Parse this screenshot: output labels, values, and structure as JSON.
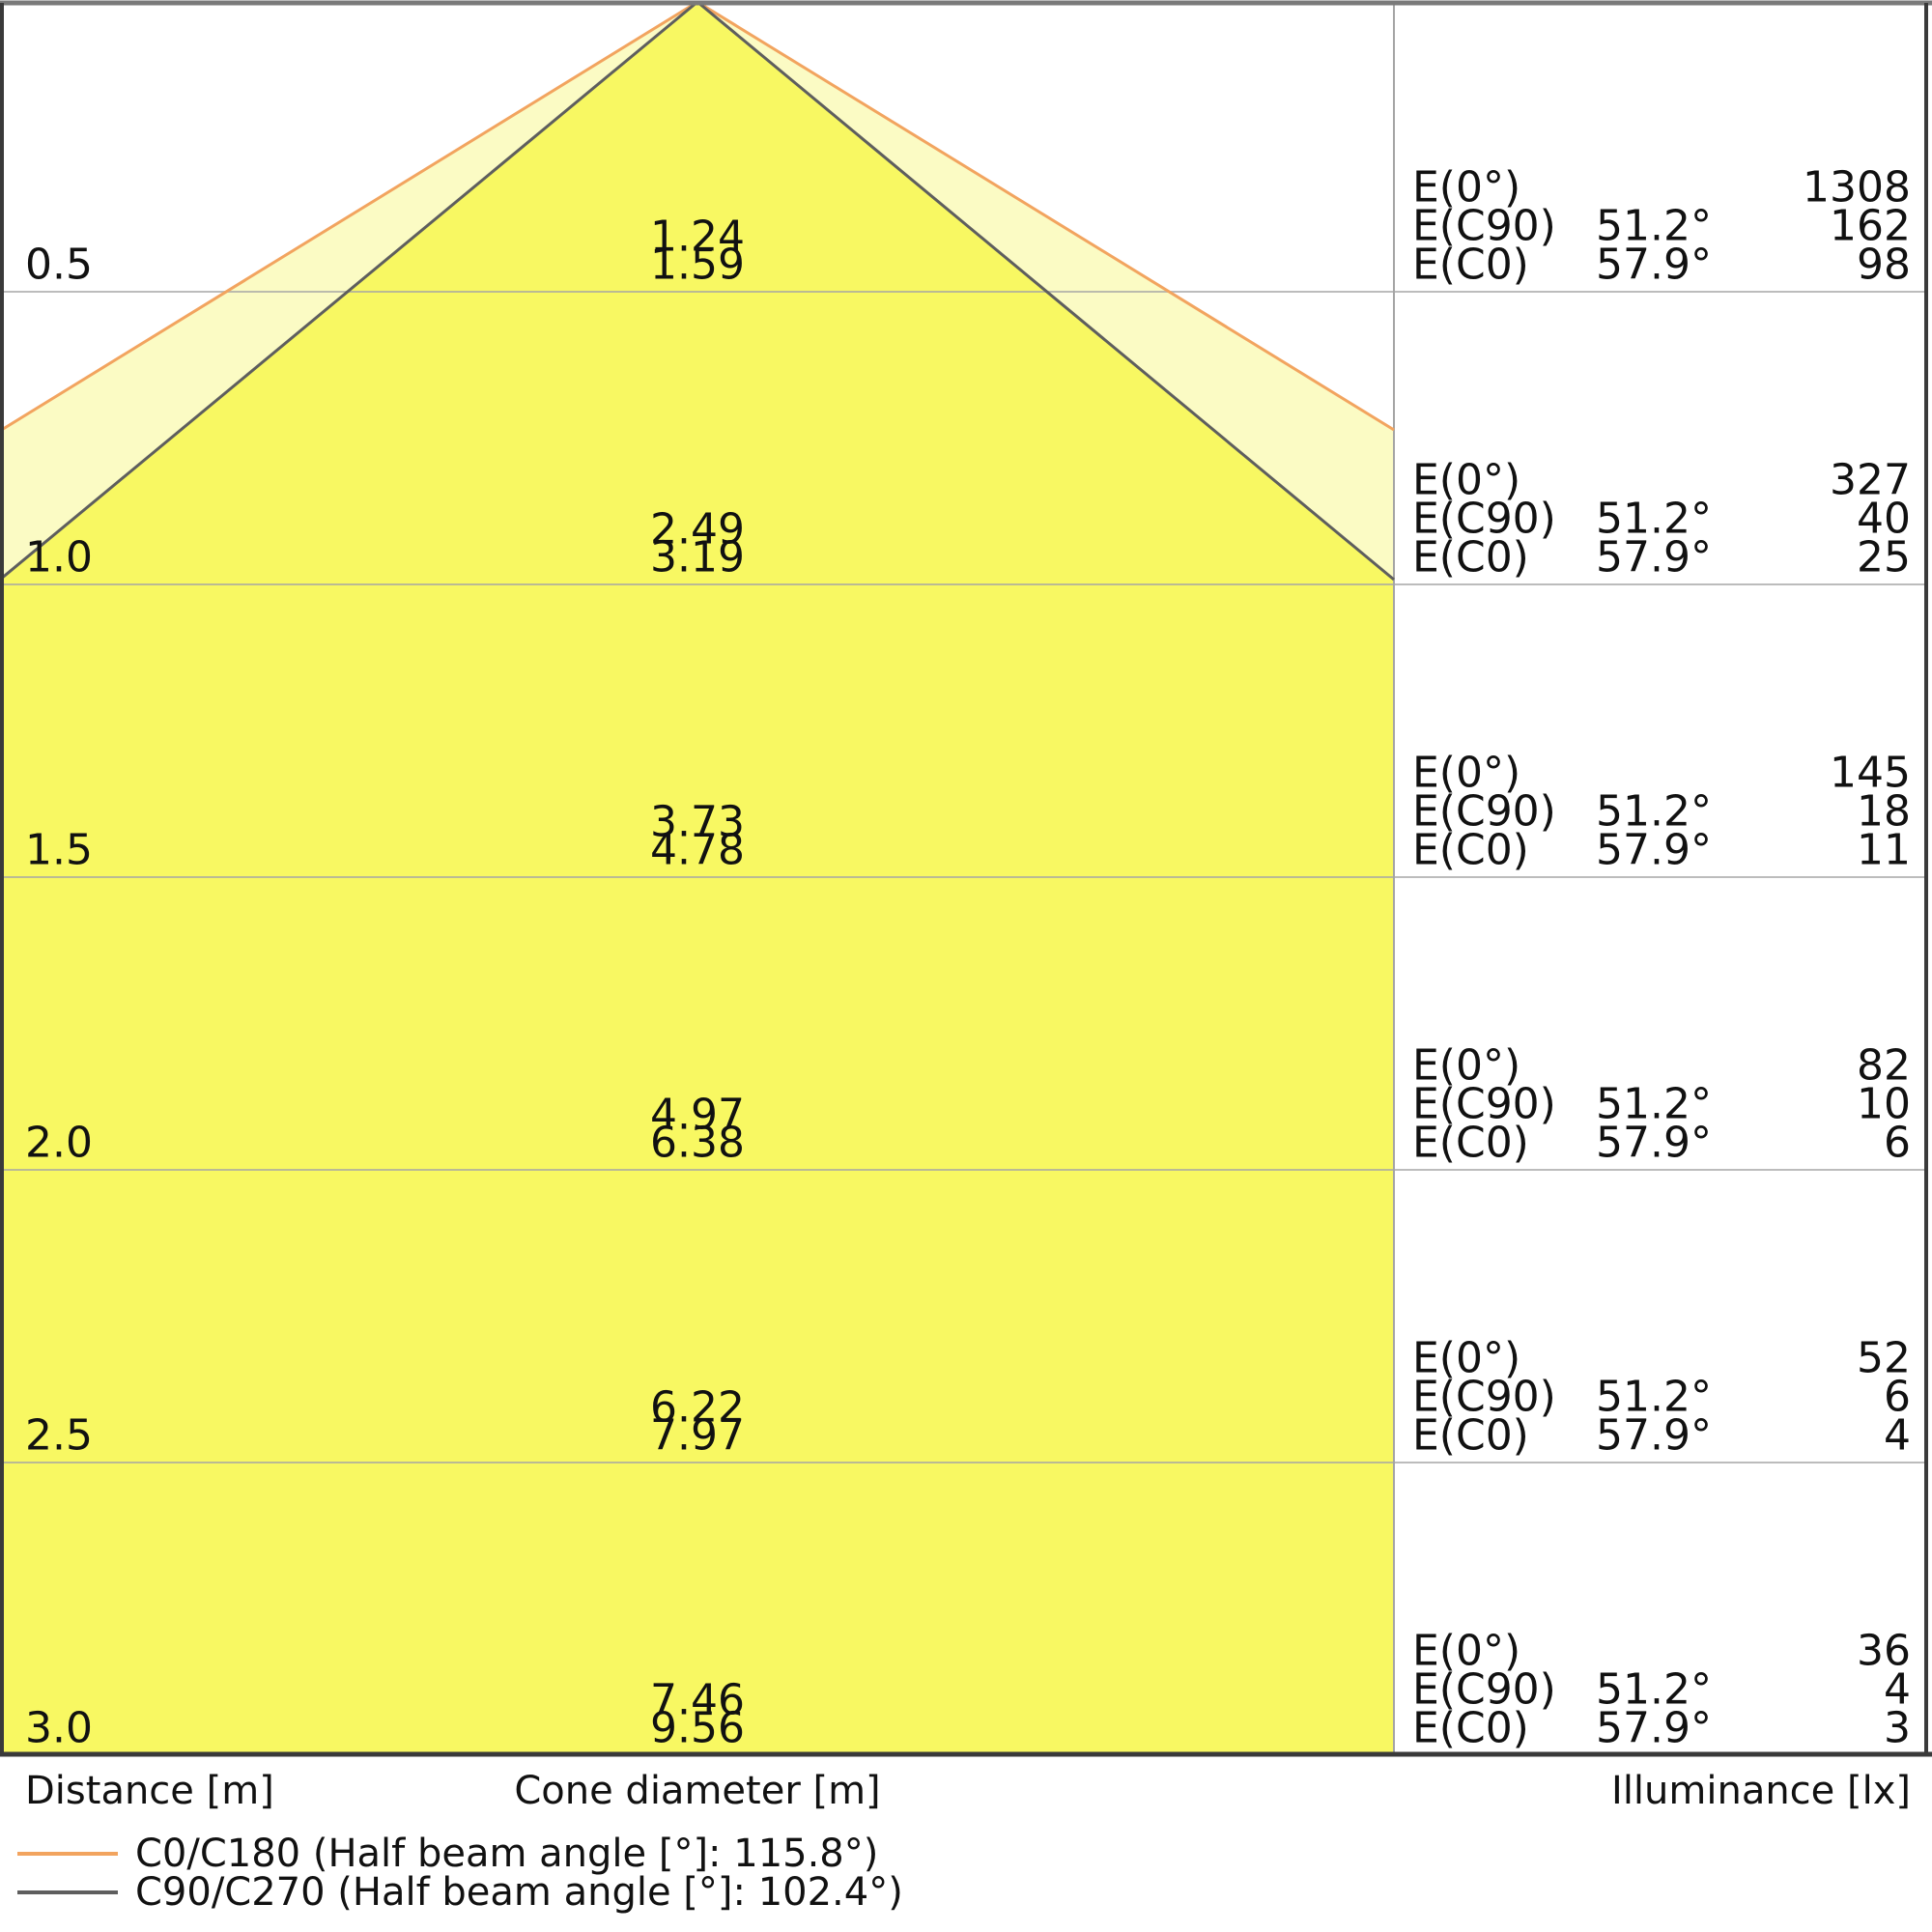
{
  "chart_data": {
    "type": "cone-diagram",
    "description": "Photometric light cone diagram: cone diameter and illuminance versus distance for beam planes C0/C180 and C90/C270",
    "axis_labels": {
      "distance": "Distance [m]",
      "cone_diameter": "Cone diameter [m]",
      "illuminance": "Illuminance [lx]"
    },
    "e_row_labels": {
      "e0": "E(0°)",
      "ec90": "E(C90)",
      "ec0": "E(C0)"
    },
    "angles": {
      "ec90": "51.2°",
      "ec0": "57.9°"
    },
    "rows": [
      {
        "distance": "0.5",
        "cone_c90": "1.24",
        "cone_c0": "1.59",
        "e0": "1308",
        "ec90": "162",
        "ec0": "98"
      },
      {
        "distance": "1.0",
        "cone_c90": "2.49",
        "cone_c0": "3.19",
        "e0": "327",
        "ec90": "40",
        "ec0": "25"
      },
      {
        "distance": "1.5",
        "cone_c90": "3.73",
        "cone_c0": "4.78",
        "e0": "145",
        "ec90": "18",
        "ec0": "11"
      },
      {
        "distance": "2.0",
        "cone_c90": "4.97",
        "cone_c0": "6.38",
        "e0": "82",
        "ec90": "10",
        "ec0": "6"
      },
      {
        "distance": "2.5",
        "cone_c90": "6.22",
        "cone_c0": "7.97",
        "e0": "52",
        "ec90": "6",
        "ec0": "4"
      },
      {
        "distance": "3.0",
        "cone_c90": "7.46",
        "cone_c0": "9.56",
        "e0": "36",
        "ec90": "4",
        "ec0": "3"
      }
    ],
    "legend": [
      {
        "name": "C0/C180",
        "label": "C0/C180 (Half beam angle [°]: 115.8°)",
        "color": "#F2A45F"
      },
      {
        "name": "C90/C270",
        "label": "C90/C270 (Half beam angle [°]: 102.4°)",
        "color": "#5E5E5E"
      }
    ],
    "half_beam_angles_deg": {
      "c0_c180": 115.8,
      "c90_c270": 102.4
    },
    "ylim_m": [
      0,
      3.0
    ],
    "grid": true
  },
  "colors": {
    "cone_inner": "#F8F862",
    "cone_outer": "#FBFBC4",
    "c0_line": "#F2A45F",
    "c90_line": "#5E5E5E",
    "grid": "#A5A5A5",
    "border": "#3A3A3A",
    "border_top": "#7A7A7A",
    "text": "#111111"
  }
}
